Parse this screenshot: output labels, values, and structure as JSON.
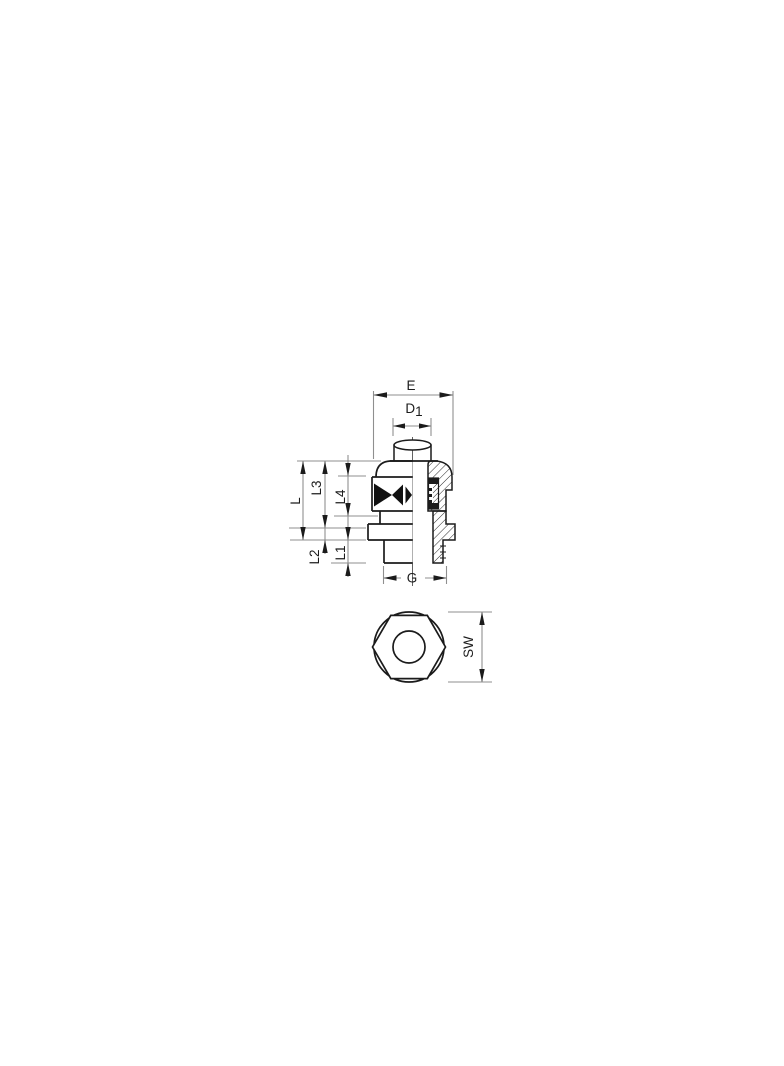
{
  "drawing": {
    "type": "technical-drawing",
    "subject": "cable-gland-cross-section-and-hex-top-view",
    "background": "#ffffff",
    "line_color": "#1b1b1b",
    "dim_line_color": "#8f8f8f",
    "labels": {
      "E": "E",
      "D1_base": "D",
      "D1_sub": "1",
      "L": "L",
      "L3": "L3",
      "L4": "L4",
      "L2": "L2",
      "L1": "L1",
      "G": "G",
      "SW": "SW"
    }
  }
}
